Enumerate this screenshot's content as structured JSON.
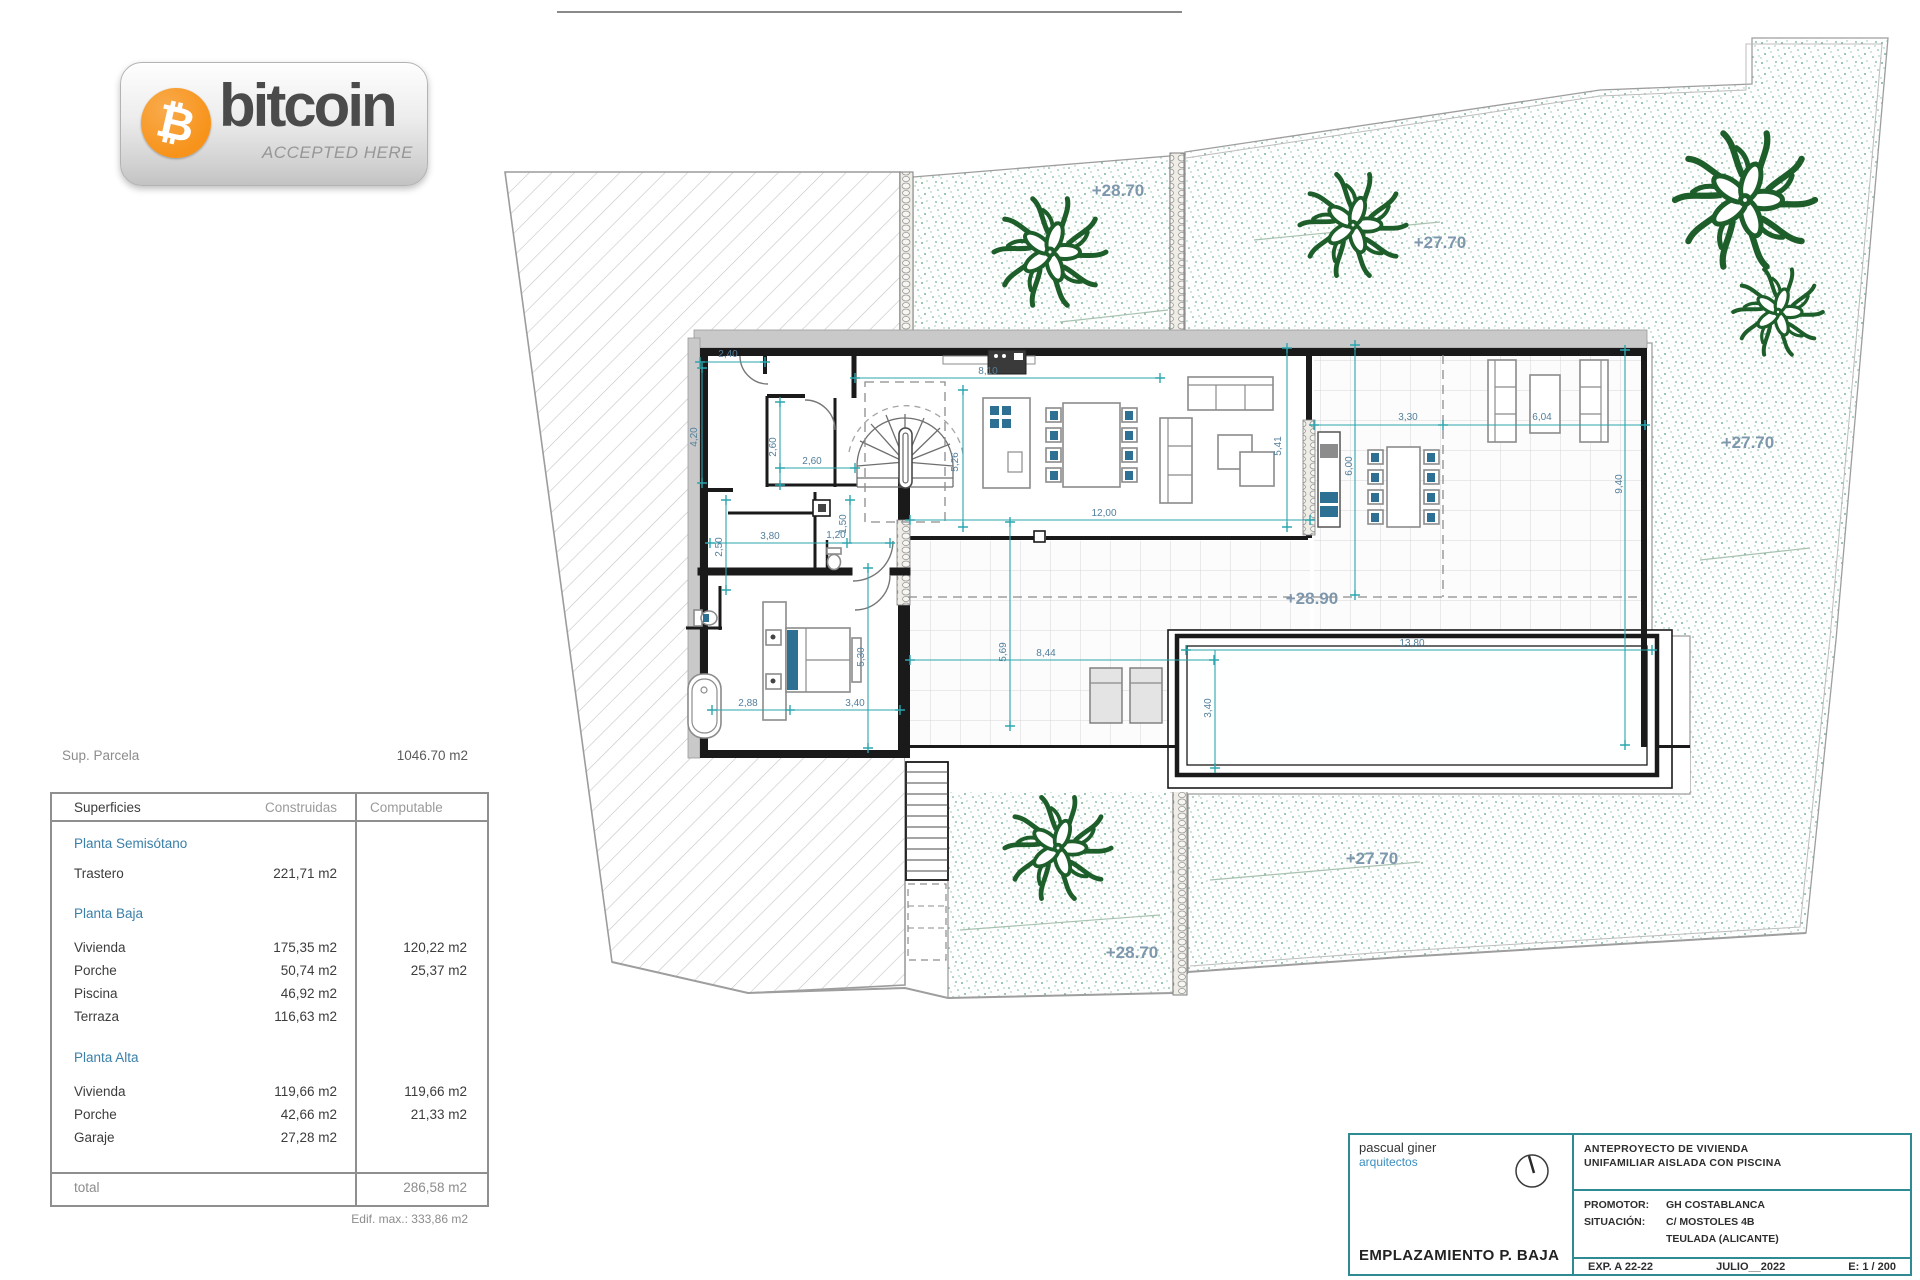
{
  "badge": {
    "brand": "bitcoin",
    "tagline": "ACCEPTED HERE",
    "symbol": "₿",
    "orange": "#f7931a"
  },
  "parcel": {
    "label": "Sup. Parcela",
    "value": "1046.70 m2"
  },
  "table": {
    "headers": {
      "col1": "Superficies",
      "col2": "Construidas",
      "col3": "Computable"
    },
    "sections": [
      {
        "title": "Planta Semisótano",
        "rows": [
          {
            "name": "Trastero",
            "built": "221,71 m2",
            "comp": ""
          }
        ]
      },
      {
        "title": "Planta Baja",
        "rows": [
          {
            "name": "Vivienda",
            "built": "175,35 m2",
            "comp": "120,22 m2"
          },
          {
            "name": "Porche",
            "built": "50,74 m2",
            "comp": "25,37 m2"
          },
          {
            "name": "Piscina",
            "built": "46,92 m2",
            "comp": ""
          },
          {
            "name": "Terraza",
            "built": "116,63 m2",
            "comp": ""
          }
        ]
      },
      {
        "title": "Planta Alta",
        "rows": [
          {
            "name": "Vivienda",
            "built": "119,66 m2",
            "comp": "119,66 m2"
          },
          {
            "name": "Porche",
            "built": "42,66 m2",
            "comp": "21,33 m2"
          },
          {
            "name": "Garaje",
            "built": "27,28 m2",
            "comp": ""
          }
        ]
      }
    ],
    "total": {
      "label": "total",
      "value": "286,58 m2"
    },
    "footnote": "Edif. max.: 333,86 m2"
  },
  "plan": {
    "dims": {
      "d240": "2,40",
      "d420": "4,20",
      "d260a": "2,60",
      "d260b": "2,60",
      "d810": "8,10",
      "d526": "5,26",
      "d541": "5,41",
      "d1200": "12,00",
      "d380": "3,80",
      "d120": "1,20",
      "d250": "2,50",
      "d150": "1,50",
      "d288": "2,88",
      "d340a": "3,40",
      "d530": "5,30",
      "d569": "5,69",
      "d844": "8,44",
      "d1380": "13,80",
      "d340b": "3,40",
      "d330": "3,30",
      "d604": "6,04",
      "d600": "6,00",
      "d940": "9,40"
    },
    "levels": {
      "l1": "+28.70",
      "l2": "+27.70",
      "l3": "+27.70",
      "l4": "+28.90",
      "l5": "+28.70",
      "l6": "+27.70"
    },
    "colors": {
      "dimension": "#2aa6ae",
      "plant": "#1d5e2a",
      "accent_blue": "#2e6f94"
    }
  },
  "titleblock": {
    "firm_name": "pascual giner",
    "firm_sub": "arquitectos",
    "drawing_title": "EMPLAZAMIENTO P. BAJA",
    "project_line1": "ANTEPROYECTO  DE VIVIENDA",
    "project_line2": "UNIFAMILIAR AISLADA CON PISCINA",
    "promoter_label": "PROMOTOR:",
    "promoter": "GH COSTABLANCA",
    "situation_label": "SITUACIÓN:",
    "situation1": "C/ MOSTOLES 4B",
    "situation2": "TEULADA  (ALICANTE)",
    "exp": "EXP. A 22-22",
    "date": "JULIO__2022",
    "scale": "E: 1 / 200"
  }
}
